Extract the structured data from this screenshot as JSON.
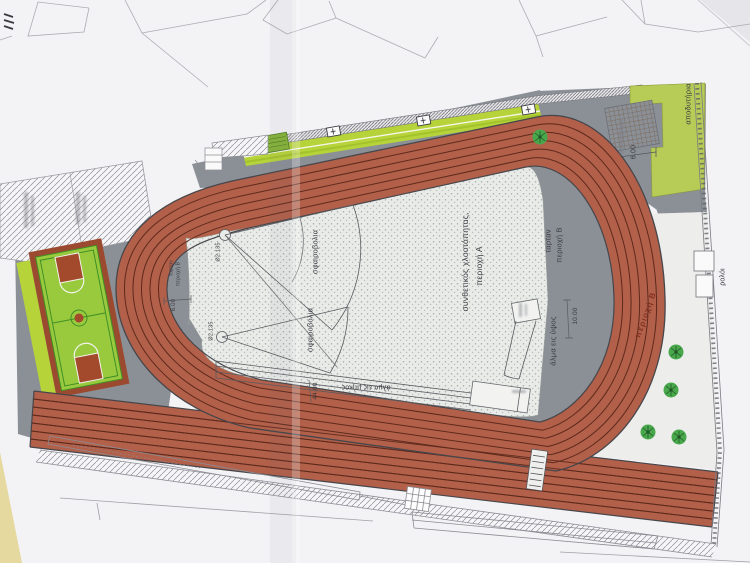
{
  "sheet": {
    "type": "site plan photo",
    "subject": "athletics track facility drawing"
  },
  "labels": {
    "infield_area": {
      "line1": "συνθετικός χλοοτάπητας,",
      "line2": "περιοχή Α"
    },
    "tartan_right": {
      "line1": "ταρταν",
      "line2": "περιοχή Β"
    },
    "tartan_left": {
      "line1": "ταρταν",
      "line2": "περιοχή Β",
      "dim": "6.00"
    },
    "shot_put": {
      "name": "σφαιροβολια",
      "circle_dia": "Ø2.135"
    },
    "long_jump": {
      "name": "άλμα εις μήκος",
      "dim": "44.00"
    },
    "high_jump": {
      "name": "άλμα εις ύψος",
      "dim": "10.00"
    },
    "track_zone_b": "περιοχή Β",
    "changing_rooms": "αποδυτήρια",
    "pergola_dim": "6.00",
    "clock": "ρολόι"
  },
  "colors": {
    "paper": "#f3f2f5",
    "track": "#b2604a",
    "lane_line": "#5d2a1c",
    "apron_gray": "#8b9097",
    "infield_concrete": "#e9ebe9",
    "walkway_lime": "#b6d339",
    "court_green": "#99ca3e",
    "court_red": "#a34a2d",
    "changing_rooms_green": "#b7cb57",
    "tree_green": "#49a84c"
  }
}
